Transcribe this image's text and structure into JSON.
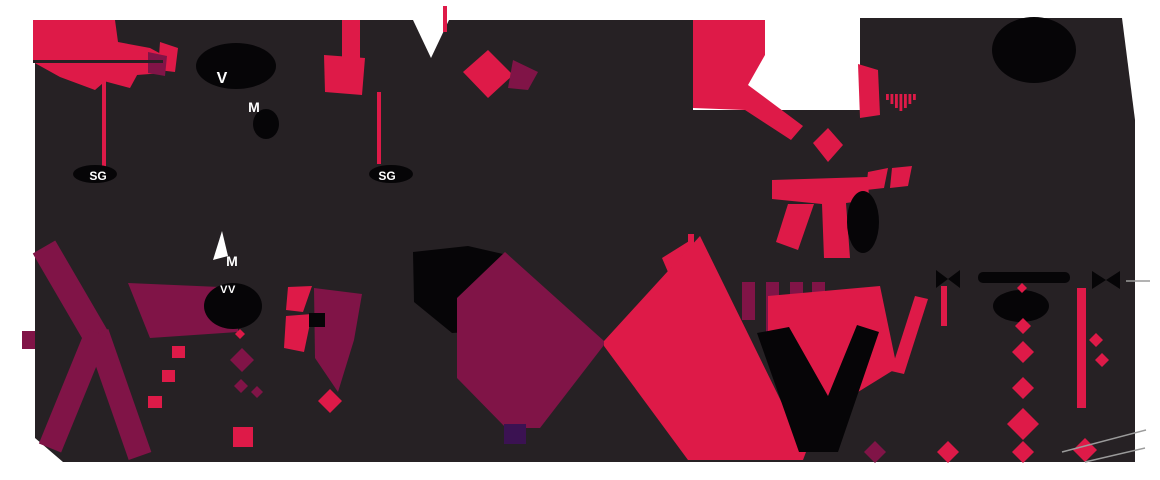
{
  "canvas": {
    "width": 1160,
    "height": 480
  },
  "colors": {
    "background": "#FFFFFF",
    "dark": "#262124",
    "black": "#060507",
    "crimson": "#DE1A48",
    "maroon": "#801447",
    "maroon_dark": "#7E2546",
    "purple": "#3B1252",
    "label_text": "#FFFFFF",
    "hairline": "#9A9A9A"
  },
  "labels": {
    "valve_top": "V",
    "motor_top": "M",
    "sg_left": "SG",
    "sg_right": "SG",
    "motor_mid": "M",
    "valve_mid": "VV"
  }
}
